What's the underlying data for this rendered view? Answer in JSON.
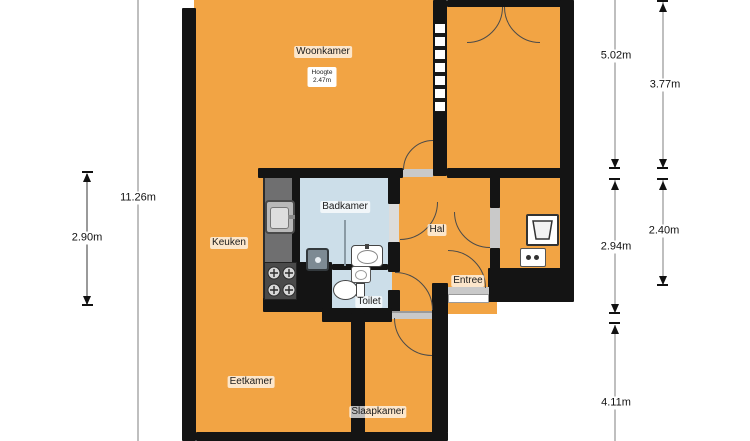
{
  "rooms": {
    "woonkamer": "Woonkamer",
    "keuken": "Keuken",
    "badkamer": "Badkamer",
    "hal": "Hal",
    "entree": "Entree",
    "toilet": "Toilet",
    "eetkamer": "Eetkamer",
    "slaapkamer": "Slaapkamer"
  },
  "height_note": {
    "label": "Hoogte",
    "value": "2.47m"
  },
  "dimensions": {
    "total_height": "11.26m",
    "left_inner": "2.90m",
    "right_top_outer": "5.02m",
    "right_top_inner": "3.77m",
    "right_mid_outer": "2.94m",
    "right_mid_inner": "2.40m",
    "right_bottom": "4.11m"
  },
  "colors": {
    "room_fill": "#F2A444",
    "wet_room_fill": "#CCDEE9",
    "wall": "#141414",
    "counter": "#6F6F70",
    "dimension_line": "#BFBFBF"
  },
  "icons": {
    "kitchen_sink": "kitchen-sink",
    "stove": "stove-4-burners",
    "shower": "shower-drain",
    "washbasin": "washbasin",
    "hand_basin": "hand-basin",
    "toilet_bowl": "toilet-bowl",
    "boiler": "boiler-sink",
    "washing_machine": "washing-machine"
  }
}
